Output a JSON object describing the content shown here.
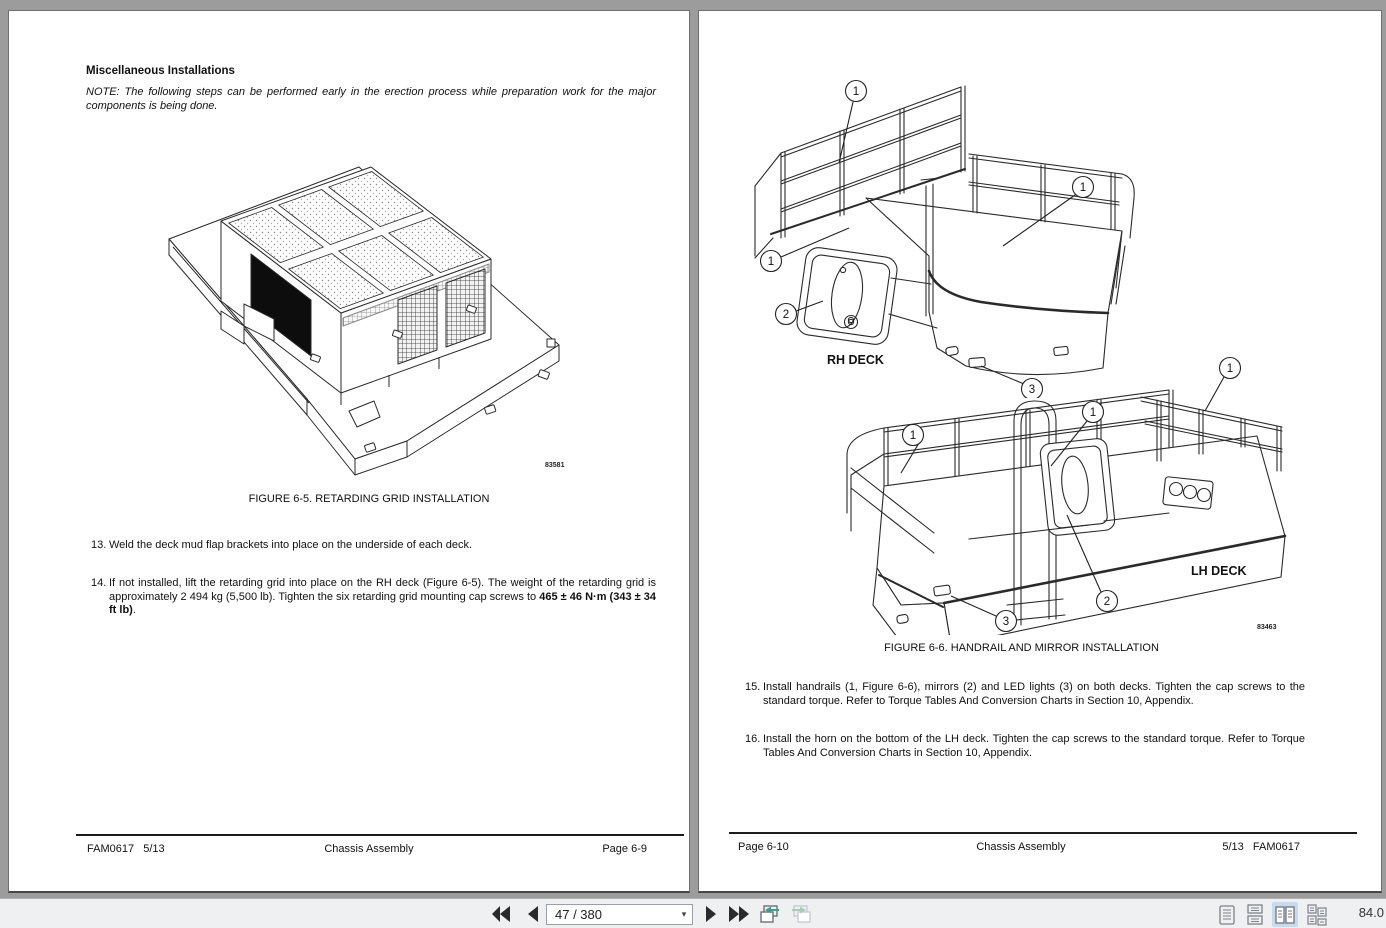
{
  "colors": {
    "canvas_bg": "#9c9c9c",
    "toolbar_bg": "#eff0f1",
    "active_layout_highlight": "#c9d9ee",
    "view_arrow_teal": "#3f9d8e"
  },
  "toolbar": {
    "page_field": "47 / 380",
    "zoom_level": "84.0",
    "icons": [
      "first-page",
      "previous-page",
      "page-number-combobox",
      "next-page",
      "last-page",
      "previous-view",
      "next-view",
      "single-page-layout",
      "continuous-layout",
      "two-page-layout",
      "two-page-continuous-layout"
    ]
  },
  "left_page": {
    "heading": "Miscellaneous Installations",
    "note": "NOTE: The following steps can be performed early in the erection process while preparation work for the major components is being done.",
    "figure": {
      "caption": "FIGURE 6-5. RETARDING GRID INSTALLATION",
      "drawing_number": "83581"
    },
    "items": [
      {
        "num": "13.",
        "text": "Weld the deck mud flap brackets into place on the underside of each deck."
      },
      {
        "num": "14.",
        "text": "If not installed, lift the retarding grid into place on the RH deck (Figure 6-5). The weight of the retarding grid is approximately 2 494 kg (5,500 lb). Tighten the six retarding grid mounting cap screws to ",
        "bold": "465 ± 46 N·m (343 ± 34 ft lb)",
        "suffix": "."
      }
    ],
    "footer": {
      "left": "FAM0617   5/13",
      "center": "Chassis Assembly",
      "right": "Page 6-9"
    }
  },
  "right_page": {
    "figure": {
      "caption": "FIGURE 6-6. HANDRAIL AND MIRROR INSTALLATION",
      "drawing_number": "83463",
      "rh_label": "RH DECK",
      "lh_label": "LH DECK",
      "callout_1": "1",
      "callout_2": "2",
      "callout_3": "3"
    },
    "items": [
      {
        "num": "15.",
        "text": "Install handrails (1, Figure 6-6), mirrors (2) and LED lights (3) on both decks. Tighten the cap screws to the standard torque. Refer to Torque Tables And Conversion Charts in Section 10, Appendix."
      },
      {
        "num": "16.",
        "text": "Install the horn on the bottom of the LH deck.  Tighten the cap screws to the standard torque. Refer to Torque Tables And Conversion Charts in Section 10, Appendix."
      }
    ],
    "footer": {
      "left": "Page 6-10",
      "center": "Chassis Assembly",
      "right": "5/13   FAM0617"
    }
  }
}
